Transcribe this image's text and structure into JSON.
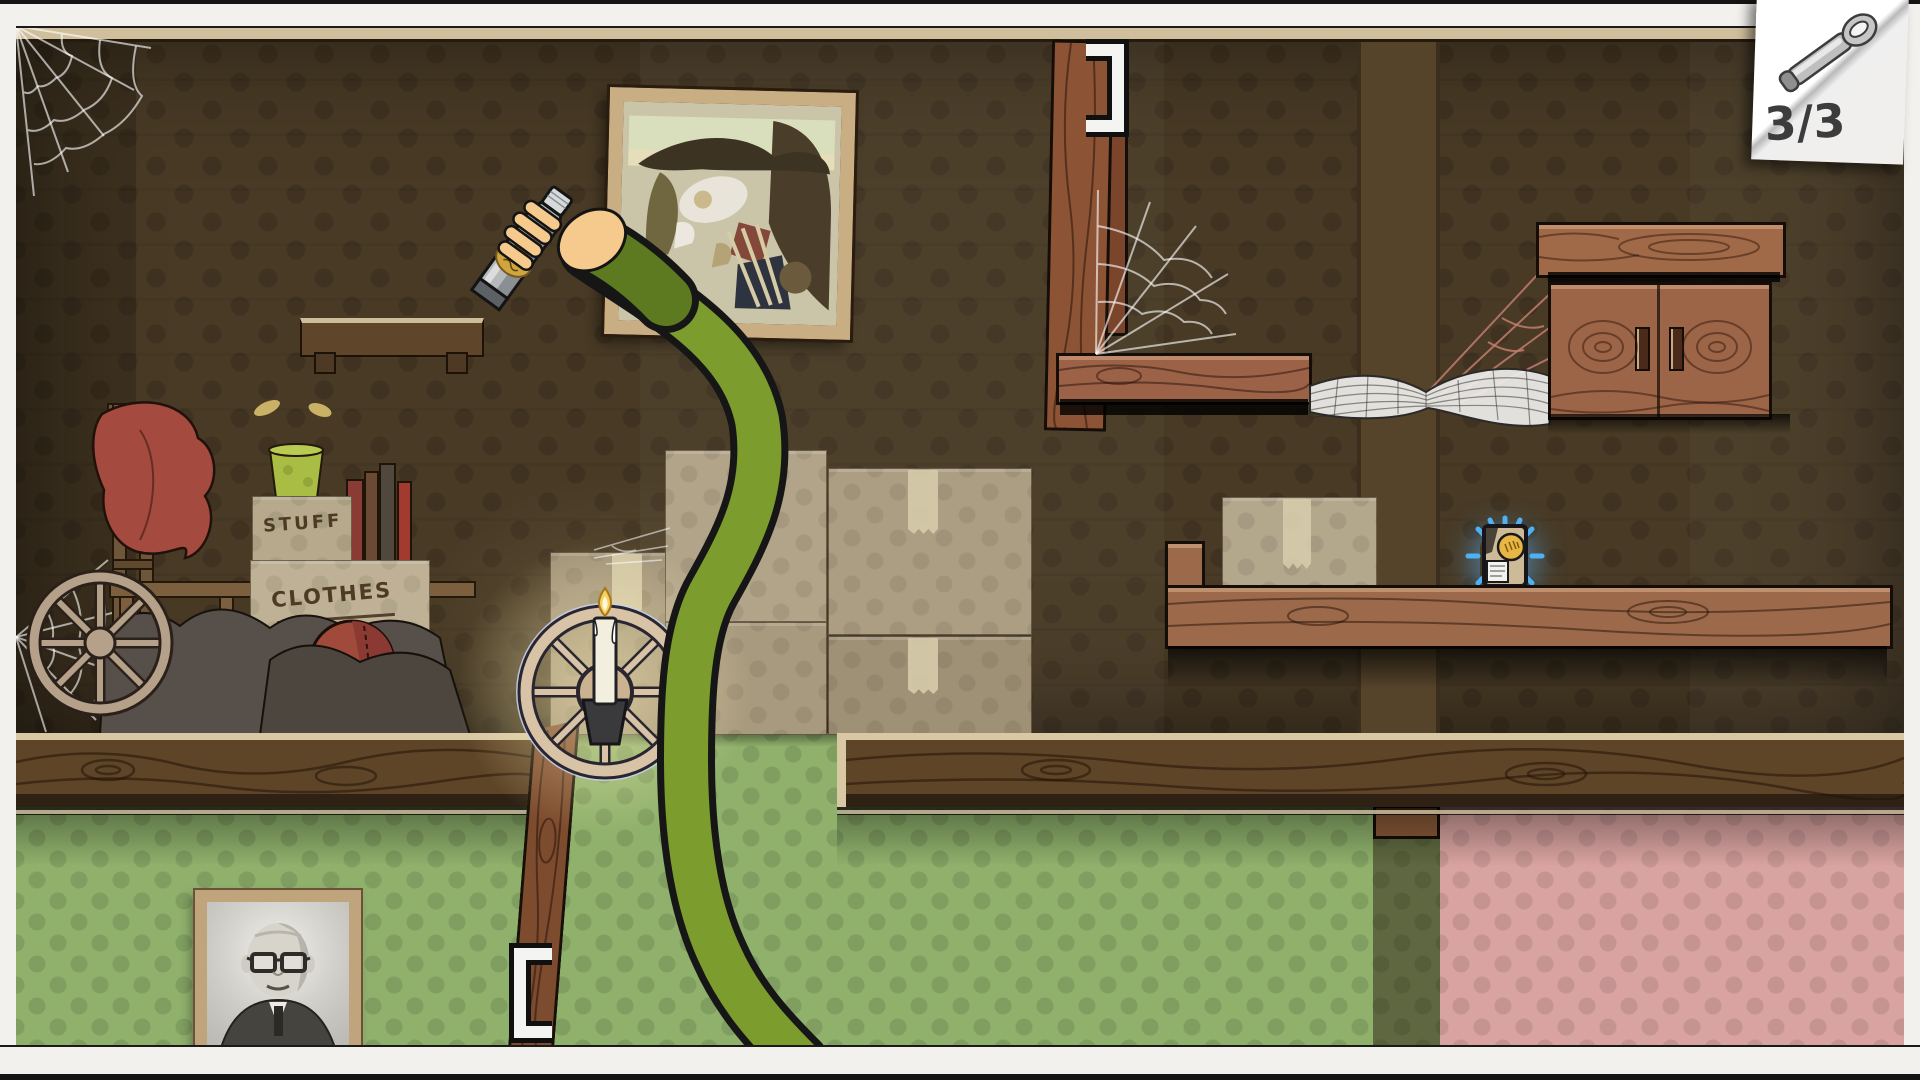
{
  "hud": {
    "collectibles": {
      "count_text": "3/3",
      "icon": "bottle-opener"
    }
  },
  "scene": {
    "boxes": {
      "stuff_label": "STUFF",
      "clothes_label": "CLOTHES"
    },
    "objects": [
      "extending-green-arm",
      "hand-holding-bottle",
      "framed-abstract-painting",
      "candle-in-wagon-wheel",
      "cardboard-boxes",
      "long-wooden-shelf",
      "glowing-collectible-card",
      "wooden-cabinet",
      "spider-webs",
      "leaning-plank",
      "metal-staple-brackets",
      "old-chair-with-red-cloth",
      "wagon-wheel",
      "patched-ball",
      "books",
      "green-cup",
      "junk-piles",
      "portrait-photo",
      "small-wall-shelf"
    ],
    "colors": {
      "attic_wall": "#483a25",
      "green_wallpaper": "#8fb16c",
      "pink_wallpaper": "#d8a3a0",
      "wood_light": "#9c6a4a",
      "wood_dark": "#5e4528",
      "trim": "#d8c8a4",
      "arm_green": "#7c9d2d",
      "collectible_glow": "#57b7f5",
      "frame_white": "#f2f1ed",
      "counter_text": "#3c3c3c"
    }
  }
}
